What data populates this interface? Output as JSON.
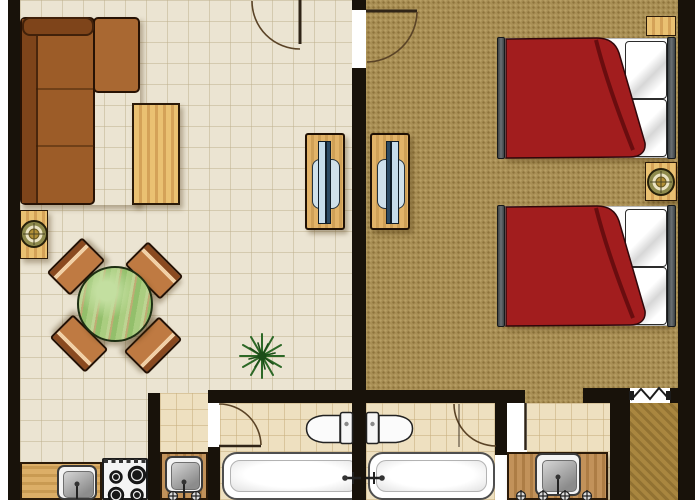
{
  "palette": {
    "wall": "#18120a",
    "floor-living": "#ebe4d2",
    "carpet": "#a98f55",
    "tile": "#eee0c0",
    "closet-a": "#a9863f",
    "closet-b": "#927232",
    "wood-a": "#eac172",
    "wood-b": "#d4a258",
    "counter-a": "#c2925a",
    "counter-b": "#ad7d45",
    "sofa": "#9c5c28",
    "sofa-dark": "#7e441a",
    "sofa-chaise": "#a96832",
    "chair": "#bf7a42",
    "chair-stripe": "#f1d0a6",
    "chair-dark": "#8a4a20",
    "table-green": "#aacd80",
    "bed-red": "#a21d1e",
    "bed-red-dark": "#5f0b0d",
    "pillow": "#ffffff",
    "tv-screen": "#c6dcea",
    "tv-dark": "#2c4a63",
    "glass": "#cfe0ea",
    "lamp-gold": "#b29038",
    "lamp-cream": "#ebe3c3",
    "lamp-olive": "#8e8a4c",
    "fixture-white": "#f6f6f6",
    "plant-a": "#2c6826",
    "plant-b": "#1c4d18",
    "door-arc": "#5a4326",
    "door-leaf": "#2f2417"
  },
  "scene": {
    "type": "apartment-floor-plan",
    "rooms": [
      {
        "name": "living-room-with-open-kitchen",
        "floor": "beige-tile",
        "furniture": [
          "corner-sofa",
          "coffee-table",
          "side-table-with-lamp",
          "round-dining-table",
          "dining-chairs",
          "tv-cabinet",
          "potted-plant",
          "kitchen-counter",
          "kitchen-sink",
          "gas-stove-4-burner"
        ]
      },
      {
        "name": "bedroom",
        "floor": "brown-carpet",
        "furniture": [
          "double-bed",
          "double-bed",
          "nightstand-with-lamp",
          "tv-cabinet",
          "closet-with-folding-door"
        ]
      },
      {
        "name": "bathroom-left",
        "floor": "beige-tile",
        "furniture": [
          "toilet",
          "bathtub",
          "vanity-washbasin"
        ]
      },
      {
        "name": "bathroom-right",
        "floor": "beige-tile",
        "furniture": [
          "toilet",
          "bathtub",
          "vanity-washbasin"
        ]
      }
    ],
    "doors": [
      "entrance-door",
      "bedroom-door",
      "bathroom-left-door",
      "bathroom-right-door",
      "closet-folding-door"
    ],
    "counts": {
      "beds": 2,
      "dining-chairs": 4,
      "bathrooms": 2,
      "toilets": 2,
      "bathtubs": 2,
      "washbasins": 3,
      "tv-cabinets": 2,
      "table-lamps": 2
    }
  }
}
